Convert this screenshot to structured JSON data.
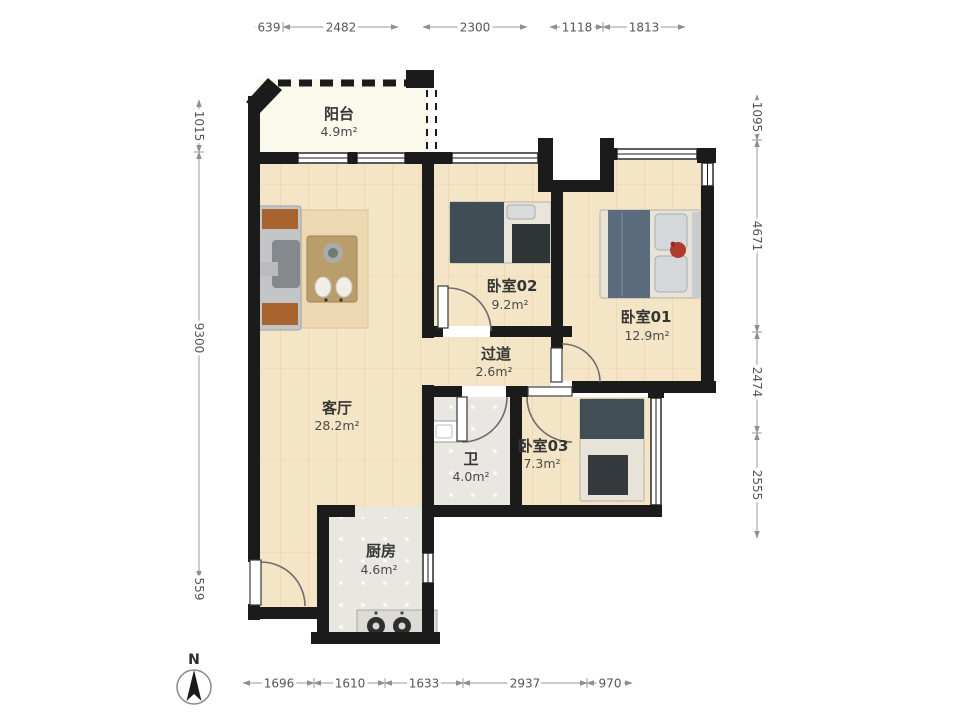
{
  "compass": {
    "label": "N"
  },
  "rooms": {
    "balcony": {
      "name": "阳台",
      "area": "4.9m²"
    },
    "living_room": {
      "name": "客厅",
      "area": "28.2m²"
    },
    "bedroom_02": {
      "name": "卧室02",
      "area": "9.2m²"
    },
    "bedroom_01": {
      "name": "卧室01",
      "area": "12.9m²"
    },
    "corridor": {
      "name": "过道",
      "area": "2.6m²"
    },
    "bathroom": {
      "name": "卫",
      "area": "4.0m²"
    },
    "bedroom_03": {
      "name": "卧室03",
      "area": "7.3m²"
    },
    "kitchen": {
      "name": "厨房",
      "area": "4.6m²"
    }
  },
  "dimensions_mm": {
    "top": [
      "639",
      "2482",
      "2300",
      "1118",
      "1813"
    ],
    "bottom": [
      "1696",
      "1610",
      "1633",
      "2937",
      "970"
    ],
    "left": [
      "1015",
      "9300",
      "559"
    ],
    "right": [
      "1095",
      "4671",
      "2474",
      "2555"
    ]
  },
  "colors": {
    "wall": "#1b1b1b",
    "wood_floor": "#f4e5c6",
    "tile_floor": "#e9e7e2",
    "balcony_floor": "#fbf8ec",
    "dimension_text": "#555555",
    "sofa_pillow_orange": "#a8632f",
    "blanket_teal": "#3f4e54",
    "blanket_blue": "#5a6b7e",
    "flower_red": "#b03a2e"
  }
}
